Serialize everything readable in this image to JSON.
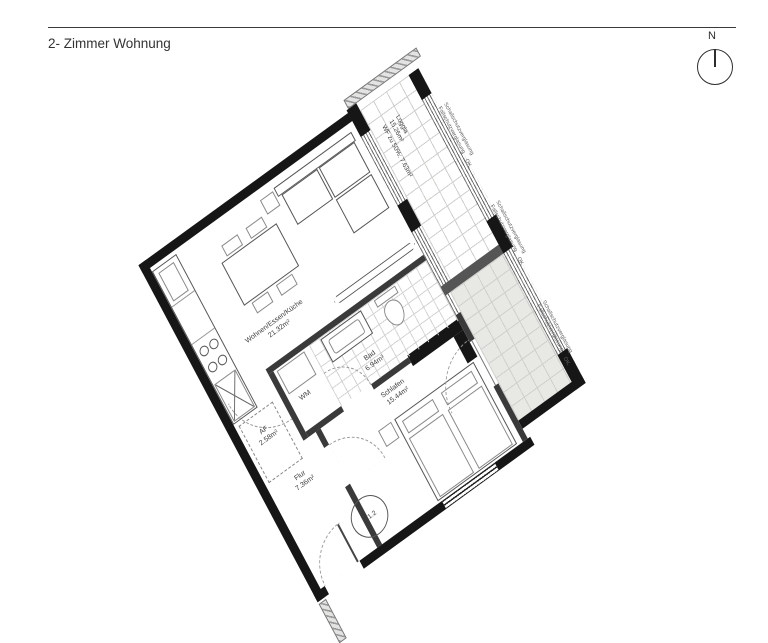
{
  "header": {
    "title": "2- Zimmer Wohnung"
  },
  "compass": {
    "north_label": "N"
  },
  "plan": {
    "unit_number": "1.1.2",
    "rooms": {
      "wohnen": {
        "name": "Wohnen/Essen/Küche",
        "area": "21.32m²"
      },
      "bad": {
        "name": "Bad",
        "area": "6.94m²"
      },
      "flur": {
        "name": "Flur",
        "area": "7.36m²"
      },
      "af": {
        "name": "AF",
        "area": "2.58m²"
      },
      "schlafen": {
        "name": "Schlafen",
        "area": "15.44m²"
      },
      "wm": {
        "name": "WM"
      },
      "loggia": {
        "name": "Loggia",
        "area": "15.26m²",
        "note": "WF zu 50%: 7.63m²"
      }
    },
    "annotations": {
      "glazing_line1": "Schallschutzverglasung",
      "glazing_line2": "Fallschutzverglasung",
      "level_mark": "OK."
    },
    "colors": {
      "wall": "#161616",
      "line": "#4a4a4a",
      "tile_line": "#cfcfcd",
      "neighbor_loggia_fill": "#e8e8e4"
    }
  }
}
